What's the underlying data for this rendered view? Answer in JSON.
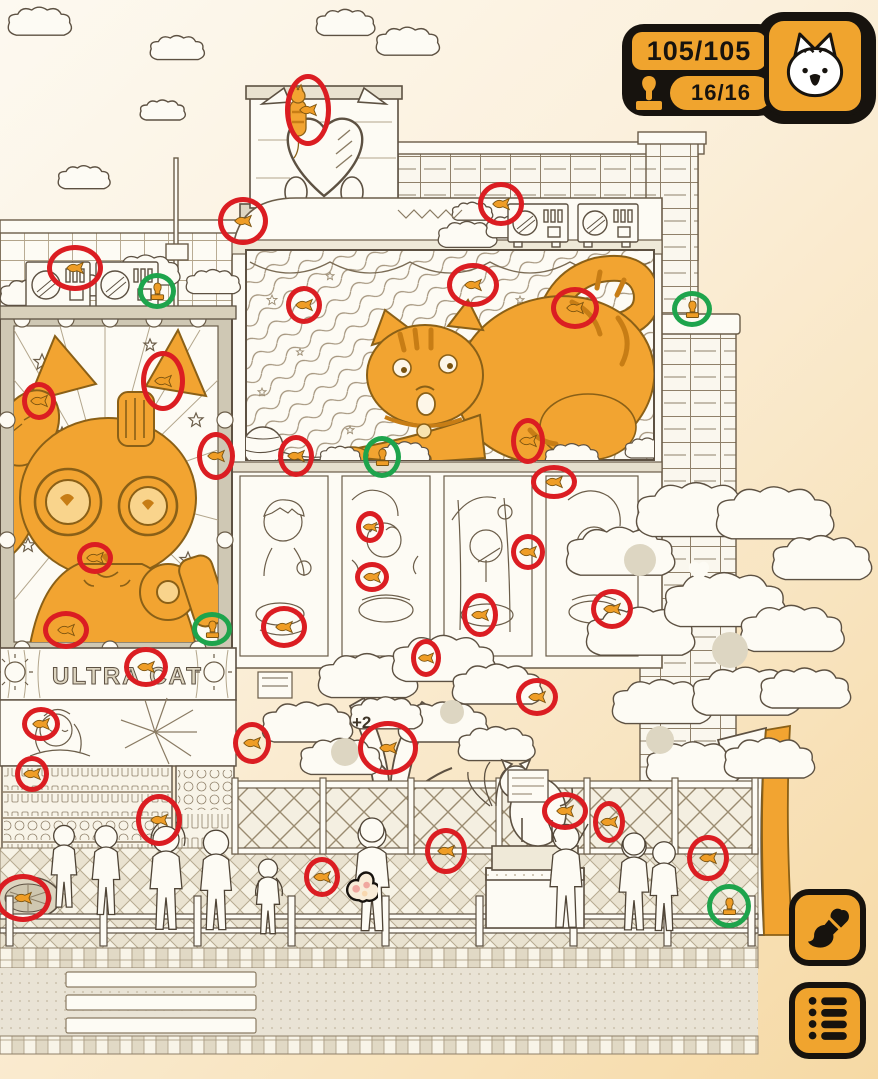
{
  "hud": {
    "found_counter": "105/105",
    "stamp_counter": "16/16",
    "icons": [
      "stamp-icon",
      "cat-face-icon"
    ],
    "colors": {
      "hud_orange": "#F0A42E",
      "hud_black": "#17130E",
      "found_circle_red": "#DB1D22",
      "stamp_circle_green": "#1EA44C",
      "cat_orange": "#F2A431"
    }
  },
  "side_buttons": [
    {
      "name": "paint-mode-button",
      "icon": "paintbrush-icon"
    },
    {
      "name": "item-list-button",
      "icon": "list-icon"
    }
  ],
  "cursor": {
    "icon": "paw-cursor-icon",
    "x": 355,
    "y": 884
  },
  "scene": {
    "shop_sign_text": "ULTRA CAT",
    "tree_label": "+2",
    "markers": {
      "found_items": [
        [
          308,
          110,
          46,
          72
        ],
        [
          243,
          221,
          50,
          48
        ],
        [
          75,
          268,
          56,
          46
        ],
        [
          501,
          204,
          46,
          44
        ],
        [
          575,
          308,
          48,
          42
        ],
        [
          473,
          285,
          52,
          44
        ],
        [
          304,
          305,
          36,
          38
        ],
        [
          163,
          381,
          44,
          60
        ],
        [
          39,
          401,
          34,
          38
        ],
        [
          216,
          456,
          38,
          48
        ],
        [
          296,
          456,
          36,
          42
        ],
        [
          528,
          441,
          34,
          46
        ],
        [
          554,
          482,
          46,
          34
        ],
        [
          95,
          558,
          36,
          32
        ],
        [
          370,
          527,
          28,
          32
        ],
        [
          372,
          577,
          34,
          30
        ],
        [
          528,
          552,
          34,
          36
        ],
        [
          284,
          627,
          46,
          42
        ],
        [
          480,
          615,
          36,
          44
        ],
        [
          612,
          609,
          42,
          40
        ],
        [
          66,
          630,
          46,
          38
        ],
        [
          146,
          667,
          44,
          40
        ],
        [
          426,
          658,
          30,
          38
        ],
        [
          537,
          697,
          42,
          38
        ],
        [
          41,
          724,
          38,
          34
        ],
        [
          32,
          774,
          34,
          36
        ],
        [
          252,
          743,
          38,
          42
        ],
        [
          388,
          748,
          60,
          54
        ],
        [
          159,
          820,
          46,
          52
        ],
        [
          565,
          811,
          46,
          38
        ],
        [
          609,
          822,
          32,
          42
        ],
        [
          708,
          858,
          42,
          46
        ],
        [
          446,
          851,
          42,
          46
        ],
        [
          322,
          877,
          36,
          40
        ],
        [
          23,
          898,
          56,
          48
        ]
      ],
      "stamps_found": [
        [
          157,
          291,
          38,
          36
        ],
        [
          692,
          309,
          40,
          36
        ],
        [
          382,
          457,
          38,
          42
        ],
        [
          212,
          629,
          40,
          34
        ],
        [
          729,
          906,
          44,
          44
        ]
      ]
    }
  }
}
